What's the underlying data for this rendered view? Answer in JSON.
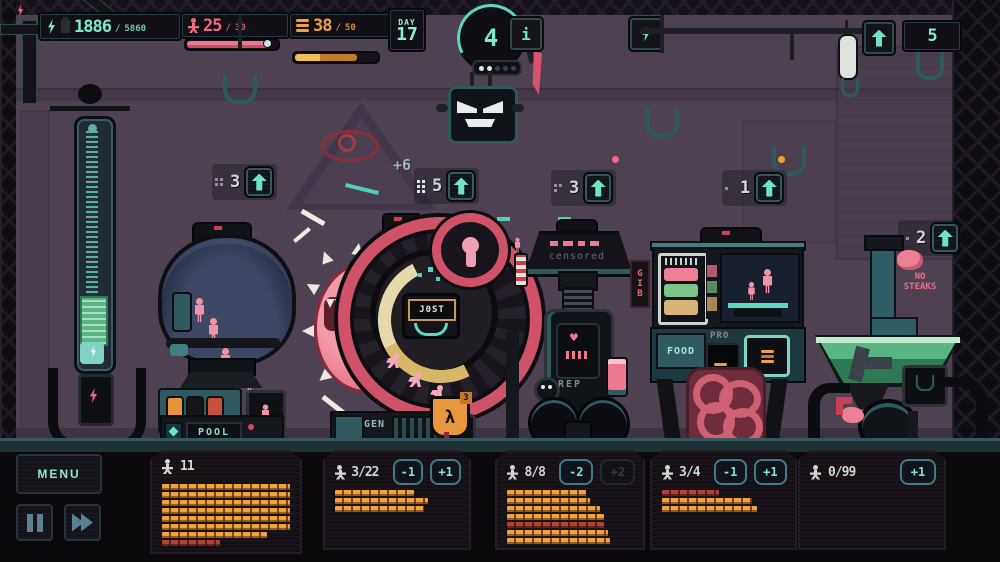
{
  "hud": {
    "sep": "/",
    "energy": {
      "value": "1886",
      "max": "5860"
    },
    "population": {
      "value": "25",
      "max": "30",
      "bar_pct": 88
    },
    "food": {
      "value": "38",
      "max": "50",
      "bar_pct": 74
    },
    "day": {
      "label": "DAY",
      "value": "17"
    },
    "crane_counter": {
      "value": "4",
      "pips_filled": 2,
      "pips_total": 5
    },
    "info_button_label": "i",
    "hook_counter": {
      "value": "5"
    }
  },
  "upgrades": {
    "gen_bonus": "+6",
    "badges": [
      {
        "machine": "pool",
        "dots": 4,
        "value": "3"
      },
      {
        "machine": "gen",
        "dots": 6,
        "value": "5"
      },
      {
        "machine": "rep",
        "dots": 3,
        "value": "3"
      },
      {
        "machine": "food",
        "dots": 1,
        "value": "1"
      },
      {
        "machine": "grinder",
        "dots": 2,
        "value": "2"
      }
    ]
  },
  "scene": {
    "pool_label": "POOL",
    "gen_label": "GEN",
    "wheel_hub_label": "J0ST",
    "rep_label": "REP",
    "censored_label": "censored",
    "food_label": "FOOD",
    "pro_label": "PRO",
    "gib_sign": "GIB",
    "no_steaks": {
      "line1": "NO",
      "line2": "STEAKS"
    },
    "lambda": {
      "symbol": "λ",
      "count": "3"
    },
    "graffiti": "OIOIO"
  },
  "bottom_bar": {
    "menu_label": "MENU",
    "panels": [
      {
        "count": "11",
        "bars": [
          {
            "pct": 100,
            "color": "orange"
          },
          {
            "pct": 100,
            "color": "orange"
          },
          {
            "pct": 100,
            "color": "orange"
          },
          {
            "pct": 100,
            "color": "orange"
          },
          {
            "pct": 100,
            "color": "orange"
          },
          {
            "pct": 100,
            "color": "orange"
          },
          {
            "pct": 82,
            "color": "orange"
          },
          {
            "pct": 45,
            "color": "red"
          }
        ]
      },
      {
        "count": "3/22",
        "minus_label": "-1",
        "plus_label": "+1",
        "bars": [
          {
            "pct": 64,
            "color": "orange"
          },
          {
            "pct": 75,
            "color": "orange"
          },
          {
            "pct": 72,
            "color": "orange"
          }
        ]
      },
      {
        "count": "8/8",
        "minus_label": "-2",
        "plus_label": "+2",
        "bars": [
          {
            "pct": 63,
            "color": "orange"
          },
          {
            "pct": 66,
            "color": "orange"
          },
          {
            "pct": 74,
            "color": "orange"
          },
          {
            "pct": 77,
            "color": "orange"
          },
          {
            "pct": 77,
            "color": "red"
          },
          {
            "pct": 80,
            "color": "orange"
          },
          {
            "pct": 82,
            "color": "orange"
          }
        ]
      },
      {
        "count": "3/4",
        "minus_label": "-1",
        "plus_label": "+1",
        "bars": [
          {
            "pct": 46,
            "color": "red"
          },
          {
            "pct": 73,
            "color": "orange"
          },
          {
            "pct": 77,
            "color": "orange"
          }
        ]
      },
      {
        "count": "0/99",
        "plus_label": "+1",
        "bars": []
      }
    ]
  }
}
